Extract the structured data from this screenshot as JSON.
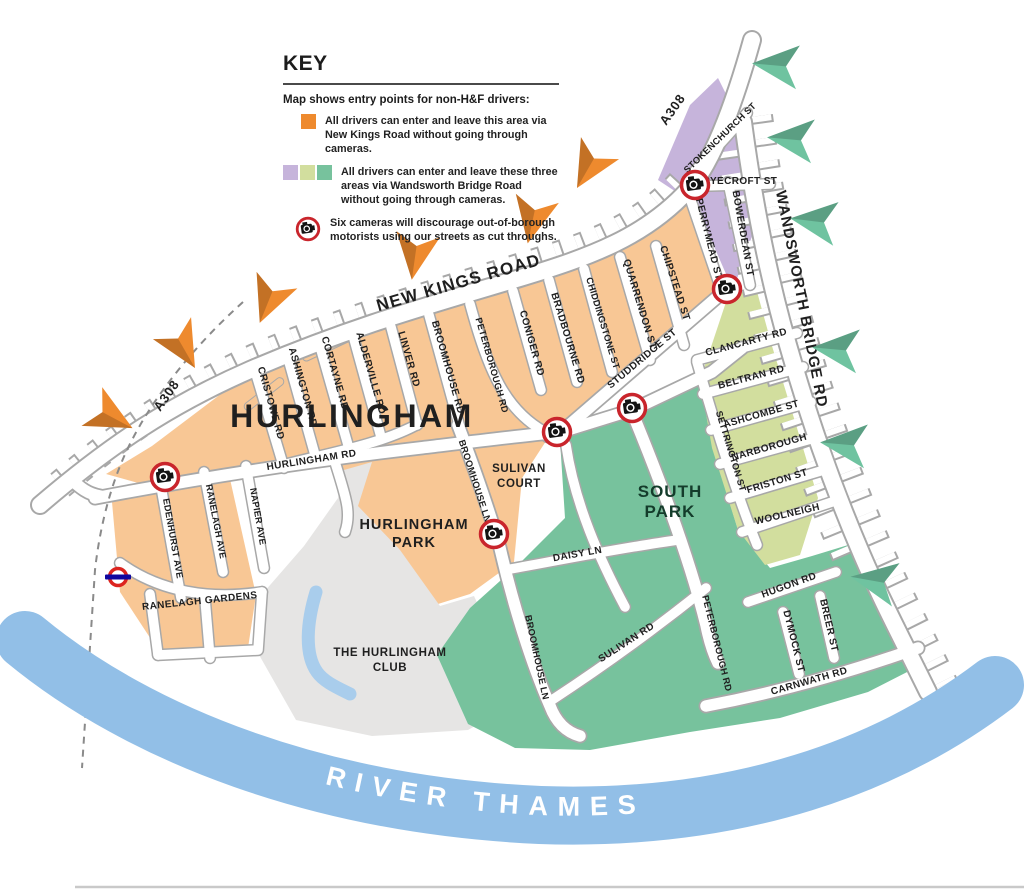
{
  "key": {
    "title": "KEY",
    "subtitle": "Map shows entry points for non-H&F drivers:",
    "item1": "All drivers can enter and leave this area via New Kings Road without going through cameras.",
    "item2": "All drivers can enter and leave these three areas via Wandsworth Bridge Road without going through cameras.",
    "item3": "Six cameras will discourage out-of-borough motorists using our streets as cut throughs."
  },
  "colors": {
    "orange_area": "#F8C795",
    "orange_arrow": "#EE8A2E",
    "purple_area": "#C6B4DB",
    "lime_area": "#D2DE9E",
    "teal_area": "#77C29D",
    "club_gray": "#E6E5E4",
    "river_blue": "#92BFE7",
    "lake_blue": "#A9CDEC",
    "camera_red": "#C9252C",
    "roundel_red": "#DC241F",
    "roundel_blue": "#10069F"
  },
  "map": {
    "river_label": "RIVER THAMES",
    "areas": {
      "hurlingham": "HURLINGHAM",
      "sulivan_1": "SULIVAN",
      "sulivan_2": "COURT",
      "southpark_1": "SOUTH",
      "southpark_2": "PARK",
      "hpark_1": "HURLINGHAM",
      "hpark_2": "PARK",
      "club_1": "THE HURLINGHAM",
      "club_2": "CLUB"
    },
    "roads": {
      "new_kings": "NEW KINGS ROAD",
      "a308_top": "A308",
      "a308_left": "A308",
      "wandsworth": "WANDSWORTH BRIDGE RD",
      "hurlingham_rd": "HURLINGHAM RD",
      "cristowe": "CRISTOWE RD",
      "ashington": "ASHINGTON RD",
      "cortayne": "CORTAYNE RD",
      "alderville": "ALDERVILLE RD",
      "linver": "LINVER RD",
      "broomhouse_rd": "BROOMHOUSE RD",
      "peterborough_rd": "PETERBOROUGH RD",
      "coniger": "CONIGER RD",
      "bradbourne": "BRADBOURNE RD",
      "chiddingstone": "CHIDDINGSTONE ST",
      "quarrendon": "QUARRENDON ST",
      "chipstead": "CHIPSTEAD ST",
      "studdridge": "STUDDRIDGE ST",
      "perrymead": "PERRYMEAD ST",
      "bowerdean": "BOWERDEAN ST",
      "stokenchurch": "STOKENCHURCH ST",
      "ryecroft": "RYECROFT ST",
      "clancarty": "CLANCARTY RD",
      "beltran": "BELTRAN RD",
      "ashcombe": "ASHCOMBE ST",
      "narborough": "NARBOROUGH",
      "friston": "FRISTON ST",
      "woolneigh": "WOOLNEIGH",
      "settrington": "SETTRINGTON ST",
      "broomhouse_ln": "BROOMHOUSE LN",
      "daisy": "DAISY LN",
      "sulivan_rd": "SULIVAN RD",
      "peterborough_s": "PETERBOROUGH RD",
      "hugon": "HUGON RD",
      "breer": "BREER ST",
      "dymock": "DYMOCK ST",
      "carnwath": "CARNWATH RD",
      "edenhurst": "EDENHURST AVE",
      "ranelagh_ave": "RANELAGH AVE",
      "napier": "NAPIER AVE",
      "ranelagh_gdns": "RANELAGH GARDENS"
    }
  }
}
